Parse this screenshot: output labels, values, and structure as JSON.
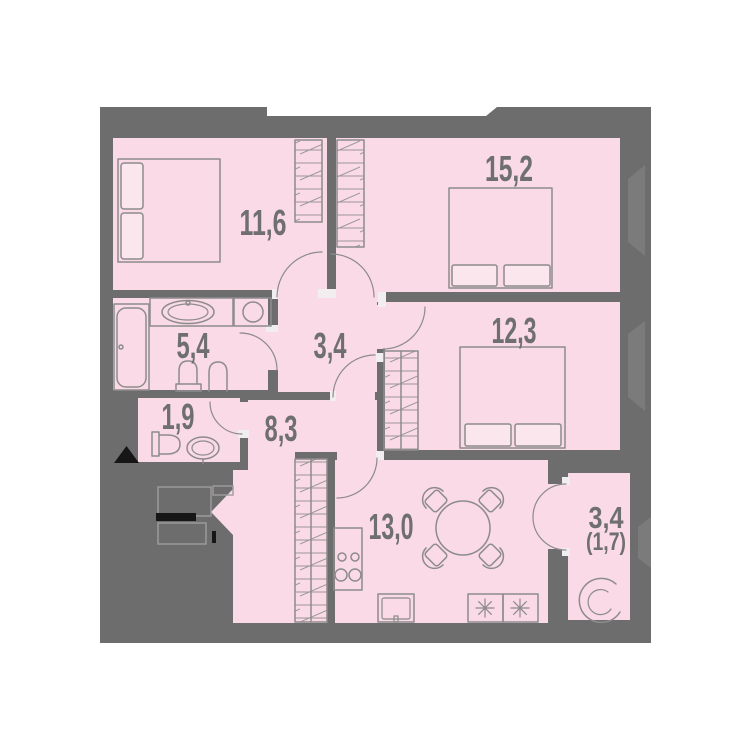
{
  "plan": {
    "type": "apartment-floor-plan",
    "colors": {
      "page_bg": "#ffffff",
      "canvas": "#6e6d6d",
      "room_fill": "#f9dae6",
      "pillow_fill": "#fbe6ee",
      "line": "#8d8b8b",
      "label": "#6f6f6f",
      "jamb": "#f2eeef",
      "neighbor": "#7c7b7b",
      "black": "#161616"
    },
    "rooms": [
      {
        "id": "bedroom-1",
        "area_label": "11,6"
      },
      {
        "id": "bedroom-2",
        "area_label": "15,2"
      },
      {
        "id": "hallway",
        "area_label": "3,4"
      },
      {
        "id": "bathroom",
        "area_label": "5,4"
      },
      {
        "id": "bedroom-3",
        "area_label": "12,3"
      },
      {
        "id": "wc",
        "area_label": "1,9"
      },
      {
        "id": "corridor",
        "area_label": "8,3"
      },
      {
        "id": "kitchen-living",
        "area_label": "13,0"
      },
      {
        "id": "balcony",
        "area_label": "3,4",
        "secondary_label": "(1,7)"
      }
    ]
  }
}
